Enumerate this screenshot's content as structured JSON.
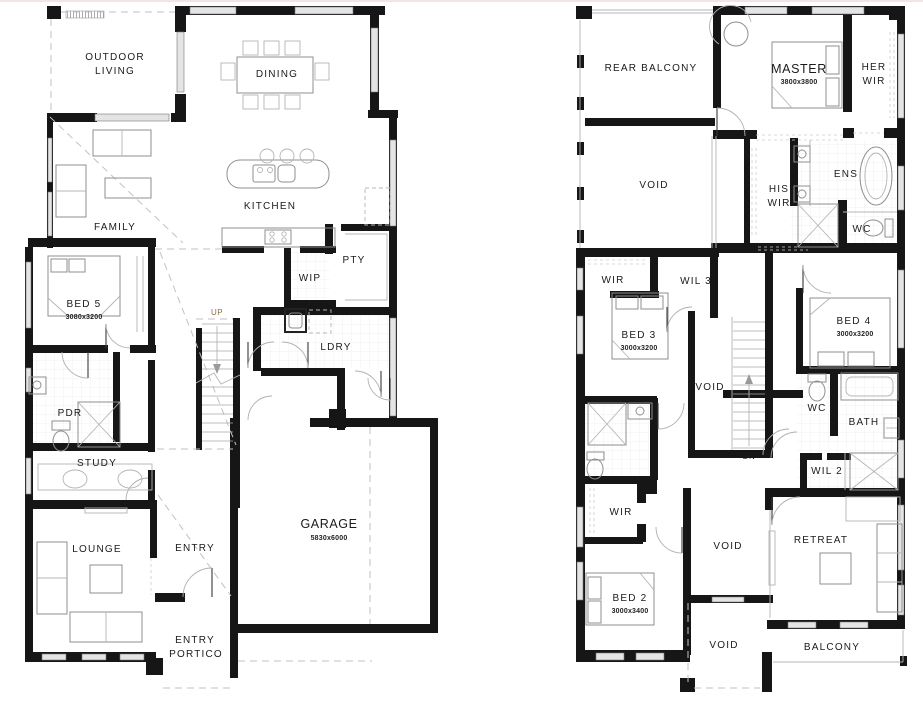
{
  "ground_floor": {
    "outdoor_living_line1": "OUTDOOR",
    "outdoor_living_line2": "LIVING",
    "dining": "DINING",
    "family": "FAMILY",
    "kitchen": "KITCHEN",
    "bed5": "BED 5",
    "bed5_dim": "3080x3200",
    "wip": "WIP",
    "pty": "PTY",
    "ldry": "LDRY",
    "up": "UP",
    "pdr": "PDR",
    "study": "STUDY",
    "lounge": "LOUNGE",
    "entry": "ENTRY",
    "garage": "GARAGE",
    "garage_dim": "5830x6000",
    "portico_line1": "ENTRY",
    "portico_line2": "PORTICO"
  },
  "first_floor": {
    "rear_balcony": "REAR BALCONY",
    "master": "MASTER",
    "master_dim": "3800x3800",
    "her_wir_line1": "HER",
    "her_wir_line2": "WIR",
    "void_upper": "VOID",
    "his_wir_line1": "HIS",
    "his_wir_line2": "WIR",
    "ens": "ENS",
    "ens_wc": "WC",
    "wir_bed3": "WIR",
    "wil3": "WIL 3",
    "bed3": "BED 3",
    "bed3_dim": "3000x3200",
    "bed4": "BED 4",
    "bed4_dim": "3000x3200",
    "void_stair": "VOID",
    "dn": "DN",
    "wc": "WC",
    "bath": "BATH",
    "wil2": "WIL 2",
    "wir_bed2": "WIR",
    "bed2": "BED 2",
    "bed2_dim": "3000x3400",
    "void_lower": "VOID",
    "retreat": "RETREAT",
    "void_bottom": "VOID",
    "balcony": "BALCONY"
  },
  "colors": {
    "wall": "#161616",
    "furniture_line": "#8f8f8f",
    "window_fill": "#e4e4e4",
    "dash_line": "#c2c2c2",
    "stair_up_label": "#8f6b45",
    "page_top_border": "#f5e4e4",
    "label_text": "#1b1b1b"
  }
}
